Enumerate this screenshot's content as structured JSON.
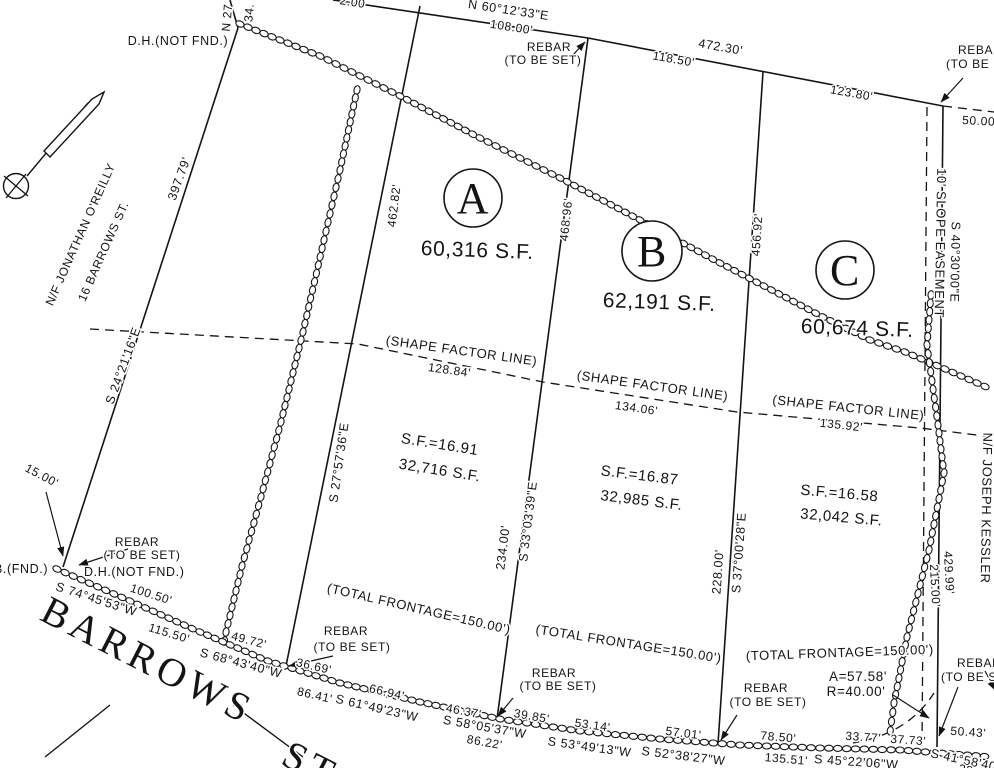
{
  "colors": {
    "ink": "#141414",
    "paper": "#ffffff"
  },
  "street": {
    "name": "BARROWS",
    "suffix": "ST."
  },
  "lots": {
    "a": {
      "letter": "A",
      "area": "60,316 S.F.",
      "shape_factor": "S.F.=16.91",
      "lower_area": "32,716 S.F.",
      "frontage": "(TOTAL FRONTAGE=150.00')"
    },
    "b": {
      "letter": "B",
      "area": "62,191 S.F.",
      "shape_factor": "S.F.=16.87",
      "lower_area": "32,985 S.F.",
      "frontage": "(TOTAL FRONTAGE=150.00')"
    },
    "c": {
      "letter": "C",
      "area": "60,674 S.F.",
      "shape_factor": "S.F.=16.58",
      "lower_area": "32,042 S.F.",
      "frontage": "(TOTAL FRONTAGE=150.00')"
    }
  },
  "abutters": {
    "west": "N/F JONATHAN O'REILLY",
    "west_address": "16 BARROWS ST.",
    "east": "N/F JOSEPH KESSLER"
  },
  "easement": {
    "label": "10' SLOPE EASEMENT"
  },
  "shape_factor_line": {
    "l1": "(SHAPE FACTOR LINE)",
    "l2": "(SHAPE FACTOR LINE)",
    "l3": "(SHAPE FACTOR LINE)"
  },
  "curve": {
    "arc": "A=57.58'",
    "radius": "R=40.00'"
  },
  "monuments": {
    "dh_top": "D.H.(NOT FND.)",
    "dh_bottom": "D.H.(NOT FND.)",
    "b_found": "B.(FND.)",
    "rebar": "REBAR",
    "to_be_set": "(TO BE SET)"
  },
  "bearings": {
    "n601233e": "N 60°12'33\"E",
    "s242116e": "S 24°21'16\"E",
    "s275736e": "S 27°57'36\"E",
    "s330339e": "S 33°03'39\"E",
    "s370028e": "S 37°00'28\"E",
    "s403000e": "S 40°30'00\"E",
    "s744553w": "S 74°45'53\"W",
    "s684340w": "S 68°43'40\"W",
    "s614923w": "S 61°49'23\"W",
    "s580537w": "S 58°05'37\"W",
    "s534913w": "S 53°49'13\"W",
    "s523827w": "S 52°38'27\"W",
    "s452206w": "S 45°22'06\"W",
    "s415840": "S 41°58'40\""
  },
  "distances": {
    "d39779": "397.79'",
    "d46282": "462.82'",
    "d46896": "468.96'",
    "d45692": "456.92'",
    "d42999": "429.99'",
    "d21500": "215.00'",
    "d23400": "234.00'",
    "d22800": "228.00'",
    "d10800": "108.00'",
    "d11850": "118.50'",
    "d47230": "472.30'",
    "d12380": "123.80'",
    "d12884": "128.84'",
    "d13406": "134.06'",
    "d13592": "135.92'",
    "d10050": "100.50'",
    "d11550": "115.50'",
    "d4972": "49.72'",
    "d3669": "36.69'",
    "d8641": "86.41'",
    "d6694": "66.94'",
    "d4637": "46.37'",
    "d3985": "39.85'",
    "d8622": "86.22'",
    "d5314": "53.14'",
    "d5701": "57.01'",
    "d7850": "78.50'",
    "d13551": "135.51'",
    "d3377": "33.77'",
    "d3773": "37.73'",
    "d5043": "50.43'",
    "d1500": "15.00'"
  },
  "fragments": {
    "n27": "N 27",
    "d34": "34.",
    "d200": "2.00",
    "d5000": "50.00'",
    "d2854": "28.54'"
  }
}
